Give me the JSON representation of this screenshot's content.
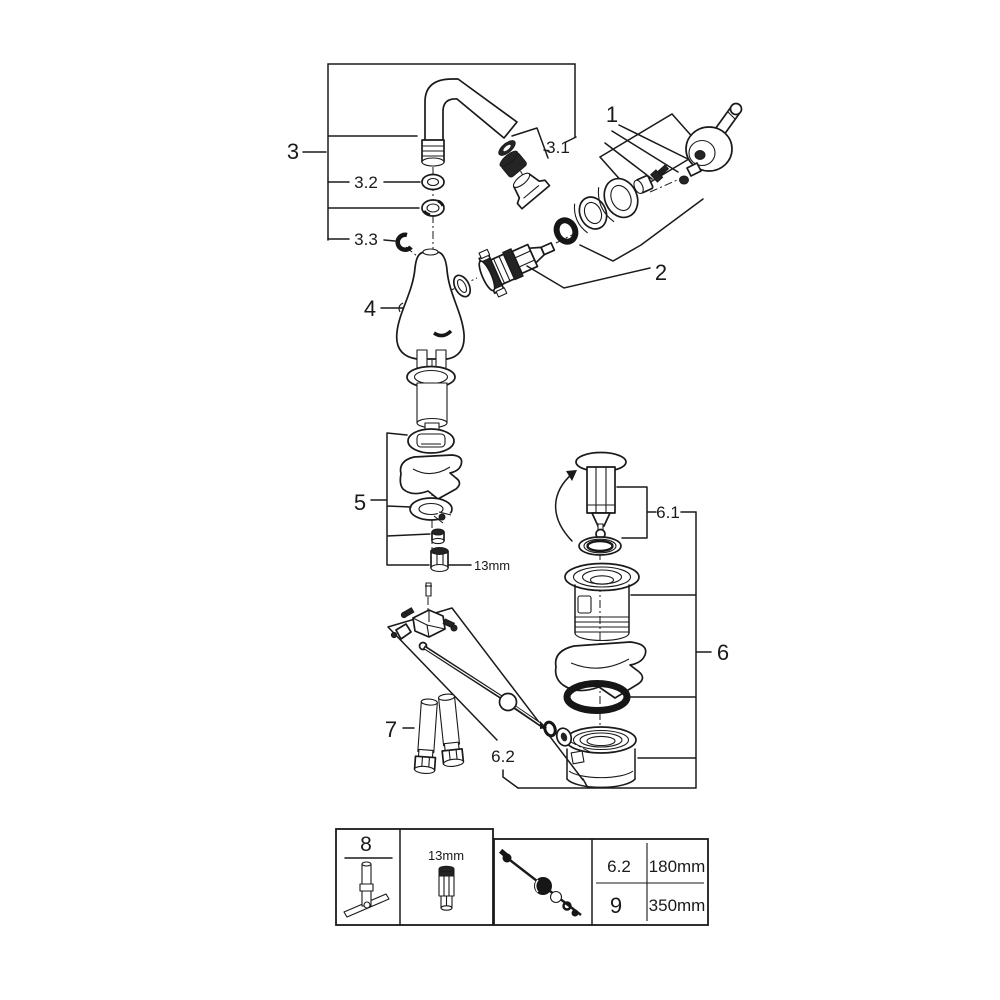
{
  "diagram_title": "Faucet exploded parts diagram",
  "labels": {
    "p1": "1",
    "p2": "2",
    "p3": "3",
    "p3_1": "3.1",
    "p3_2": "3.2",
    "p3_3": "3.3",
    "p4": "4",
    "p5": "5",
    "p5_size": "13mm",
    "p6": "6",
    "p6_1": "6.1",
    "p6_2": "6.2",
    "p7": "7"
  },
  "legend": {
    "tool_number": "8",
    "socket_size": "13mm",
    "rows": [
      {
        "ref": "6.2",
        "length": "180mm"
      },
      {
        "ref": "9",
        "length": "350mm"
      }
    ]
  },
  "colors": {
    "line": "#1a1a1a",
    "background": "#ffffff"
  }
}
